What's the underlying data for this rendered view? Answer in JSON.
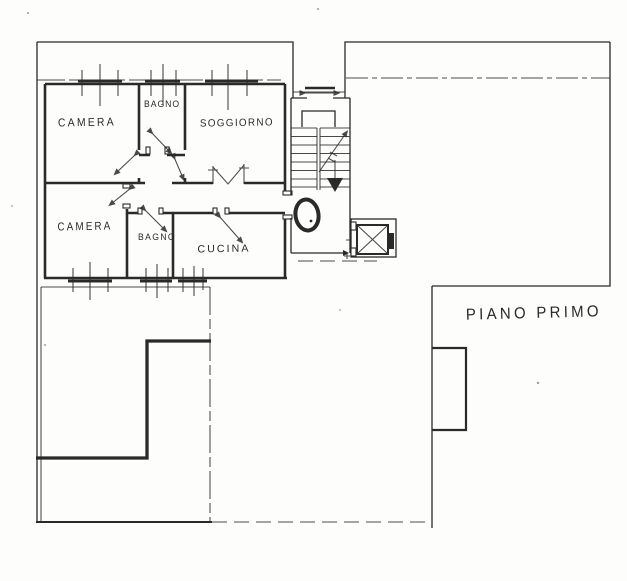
{
  "page": {
    "background": "#fdfdfb",
    "ink": "#2a2a28"
  },
  "plan": {
    "floor_label": "PIANO PRIMO",
    "rooms": [
      {
        "id": "camera-1",
        "name": "CAMERA"
      },
      {
        "id": "bagno-1",
        "name": "BAGNO"
      },
      {
        "id": "soggiorno",
        "name": "SOGGIORNO"
      },
      {
        "id": "camera-2",
        "name": "CAMERA"
      },
      {
        "id": "bagno-2",
        "name": "BAGNO"
      },
      {
        "id": "cucina",
        "name": "CUCINA"
      }
    ]
  }
}
